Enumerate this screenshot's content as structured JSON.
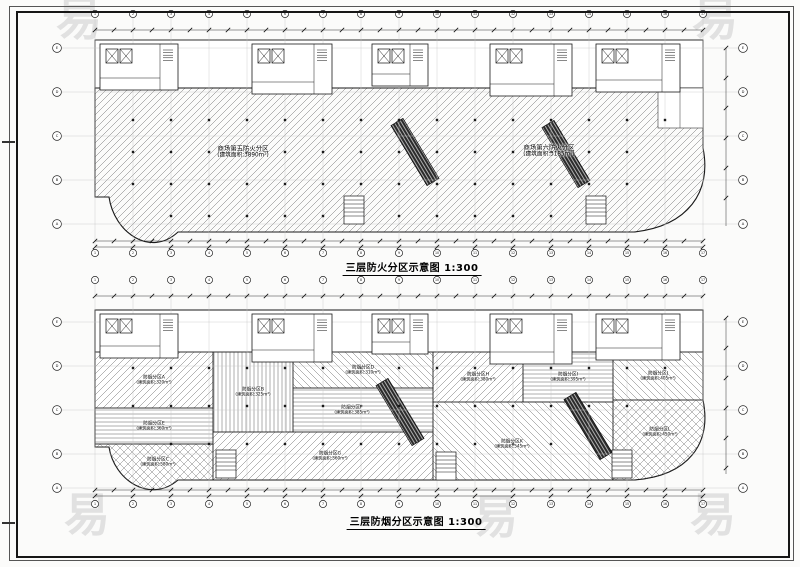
{
  "watermark": {
    "glyph": "易"
  },
  "upper_plan": {
    "title": "三层防火分区示意图 1:300",
    "compartments": [
      {
        "name": "商场第五防火分区",
        "area": "(建筑面积:3890m²)"
      },
      {
        "name": "商场第六防火分区",
        "area": "(建筑面积:3185m²)"
      }
    ],
    "axis": {
      "top": [
        "1",
        "2",
        "3",
        "4",
        "5",
        "6",
        "7",
        "8",
        "9",
        "10",
        "11",
        "12",
        "13",
        "14",
        "15",
        "16",
        "17"
      ],
      "side": [
        "E",
        "D",
        "C",
        "B",
        "A"
      ]
    }
  },
  "lower_plan": {
    "title": "三层防烟分区示意图 1:300",
    "zones": [
      {
        "name": "防烟分区A",
        "area": "(建筑面积:320m²)"
      },
      {
        "name": "防烟分区B",
        "area": "(建筑面积:325m²)"
      },
      {
        "name": "防烟分区C",
        "area": "(建筑面积:580m²)"
      },
      {
        "name": "防烟分区D",
        "area": "(建筑面积:310m²)"
      },
      {
        "name": "防烟分区E",
        "area": "(建筑面积:360m²)"
      },
      {
        "name": "防烟分区F",
        "area": "(建筑面积:385m²)"
      },
      {
        "name": "防烟分区G",
        "area": "(建筑面积:560m²)"
      },
      {
        "name": "防烟分区H",
        "area": "(建筑面积:380m²)"
      },
      {
        "name": "防烟分区I",
        "area": "(建筑面积:395m²)"
      },
      {
        "name": "防烟分区J",
        "area": "(建筑面积:405m²)"
      },
      {
        "name": "防烟分区K",
        "area": "(建筑面积:545m²)"
      },
      {
        "name": "防烟分区L",
        "area": "(建筑面积:450m²)"
      }
    ],
    "axis": {
      "top": [
        "1",
        "2",
        "3",
        "4",
        "5",
        "6",
        "7",
        "8",
        "9",
        "10",
        "11",
        "12",
        "13",
        "14",
        "15",
        "16",
        "17"
      ],
      "side": [
        "E",
        "D",
        "C",
        "B",
        "A"
      ]
    }
  }
}
